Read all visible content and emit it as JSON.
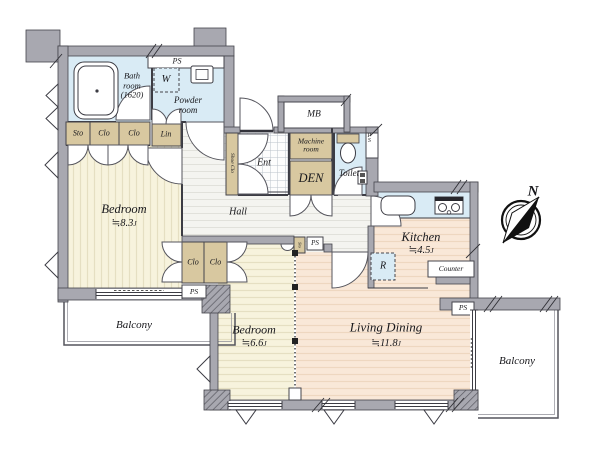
{
  "colors": {
    "wall": "#a8a8b0",
    "water_room": "#d9ebf5",
    "closet": "#d8c8a0",
    "bedroom_floor": "#f7f3dd",
    "living_floor": "#f9e8d8",
    "hall_floor": "#f4f4f0"
  },
  "rooms": {
    "bathroom": {
      "name": "Bath\nroom\n(1620)"
    },
    "powder_room": {
      "name": "Powder\nroom"
    },
    "bedroom_main": {
      "name": "Bedroom",
      "size": "≒8.3",
      "unit": "J"
    },
    "bedroom_second": {
      "name": "Bedroom",
      "size": "≒6.6",
      "unit": "J"
    },
    "living_dining": {
      "name": "Living Dining",
      "size": "≒11.8",
      "unit": "J"
    },
    "kitchen": {
      "name": "Kitchen",
      "size": "≒4.5",
      "unit": "J"
    },
    "den": {
      "name": "DEN"
    },
    "toilet": {
      "name": "Toilet"
    },
    "hall": {
      "name": "Hall"
    },
    "entrance": {
      "name": "Ent"
    },
    "machine_room": {
      "name": "Machine\nroom"
    },
    "balcony_left": {
      "name": "Balcony"
    },
    "balcony_right": {
      "name": "Balcony"
    }
  },
  "storage": {
    "sto": "Sto",
    "clo": "Clo",
    "lin": "Lin",
    "shoe_closet": "Shoe Clo",
    "sto_small": "Sto"
  },
  "fixtures": {
    "washer": "W",
    "fridge": "R",
    "counter": "Counter",
    "meter_box": "MB",
    "pipe_space": "PS"
  },
  "compass": {
    "north": "N"
  }
}
